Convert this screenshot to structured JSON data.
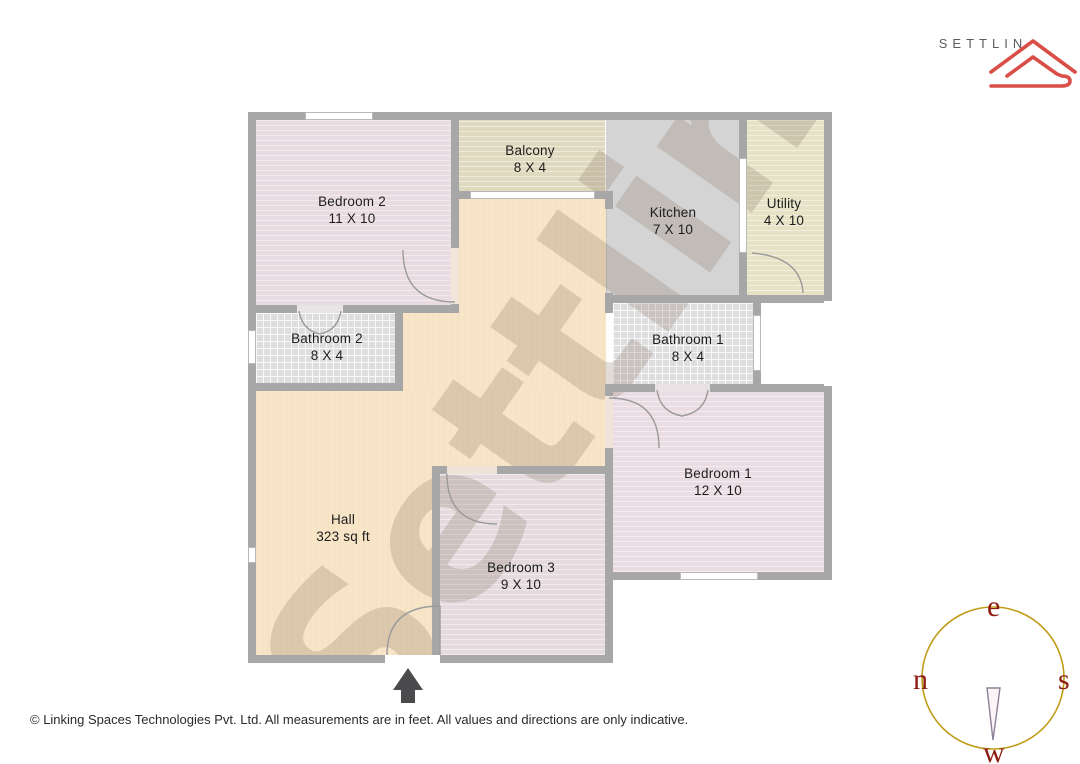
{
  "brand": {
    "name": "SETTLIN"
  },
  "plan": {
    "watermark": "Settlin",
    "rooms": [
      {
        "id": "bedroom-2",
        "name": "Bedroom 2",
        "dims": "11 X 10"
      },
      {
        "id": "balcony",
        "name": "Balcony",
        "dims": "8 X 4"
      },
      {
        "id": "kitchen",
        "name": "Kitchen",
        "dims": "7 X 10"
      },
      {
        "id": "utility",
        "name": "Utility",
        "dims": "4 X 10"
      },
      {
        "id": "bathroom-2",
        "name": "Bathroom 2",
        "dims": "8 X 4"
      },
      {
        "id": "bathroom-1",
        "name": "Bathroom 1",
        "dims": "8 X 4"
      },
      {
        "id": "hall",
        "name": "Hall",
        "dims": "323 sq ft"
      },
      {
        "id": "bedroom-1",
        "name": "Bedroom 1",
        "dims": "12 X 10"
      },
      {
        "id": "bedroom-3",
        "name": "Bedroom 3",
        "dims": "9 X 10"
      }
    ]
  },
  "compass": {
    "top": "e",
    "left": "n",
    "right": "s",
    "bottom": "w"
  },
  "footer": {
    "text": "© Linking Spaces Technologies Pvt. Ltd. All measurements are in feet. All values and directions are only indicative."
  },
  "colors": {
    "brand_red": "#d94f48",
    "wall_gray": "#a7a7a7",
    "hall_floor": "#f8e5c7",
    "bedroom_floor": "#e8dce2",
    "bathroom_floor": "#dedee0",
    "kitchen_floor": "#d4d4d4",
    "balcony_floor": "#dfdabf",
    "utility_floor": "#e6e2c6",
    "compass_ring": "#bf9b16",
    "compass_letters": "#8e1b0f"
  }
}
